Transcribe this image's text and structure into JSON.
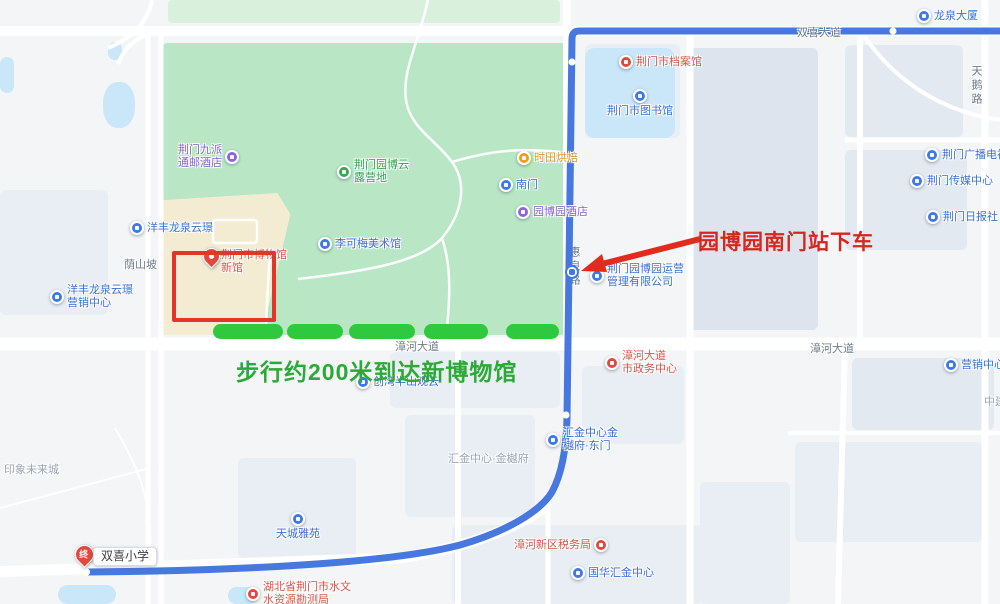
{
  "map_app": "chinese-web-map-route-view",
  "annotations": {
    "alight_text": "园博园南门站下车",
    "walk_text": "步行约200米到达新博物馆",
    "end_pin_char": "终",
    "end_label": "双喜小学"
  },
  "colors": {
    "route_blue": "#4678df",
    "walk_dash_green": "#2fc93f",
    "walk_text_green": "#2caa36",
    "annotation_red": "#d8251d",
    "highlight_box_red": "#e2352b",
    "park_green": "#b9e7c6",
    "water_blue": "#c9e7f8"
  },
  "road_labels": [
    {
      "id": "shuangxi-avenue",
      "text": "双喜大道",
      "x": 797,
      "y": 24,
      "vertical": false
    },
    {
      "id": "zhanghe-avenue-center",
      "text": "漳河大道",
      "x": 395,
      "y": 338,
      "vertical": false
    },
    {
      "id": "zhanghe-avenue-east",
      "text": "漳河大道",
      "x": 810,
      "y": 340,
      "vertical": false
    },
    {
      "id": "tiane-road",
      "text": "天鹅路",
      "x": 968,
      "y": 65,
      "vertical": true
    },
    {
      "id": "yinshanpo-road",
      "text": "荫山坡",
      "x": 124,
      "y": 256,
      "vertical": false
    },
    {
      "id": "huiquan-road",
      "text": "惠泉路",
      "x": 566,
      "y": 246,
      "vertical": true
    }
  ],
  "area_labels": [
    {
      "id": "huijin-center-jinyuefu",
      "text": "汇金中心·金樾府",
      "x": 448,
      "y": 450
    },
    {
      "id": "yinxiang-future-city",
      "text": "印象未来城",
      "x": 4,
      "y": 461
    },
    {
      "id": "zhongjian-partial",
      "text": "中建",
      "x": 984,
      "y": 393
    }
  ],
  "pois": [
    {
      "id": "longquan-tower",
      "kind": "blue",
      "x": 924,
      "y": 16,
      "side": "right",
      "lines": [
        "龙泉大厦"
      ]
    },
    {
      "id": "jingmen-archives",
      "kind": "red",
      "x": 626,
      "y": 62,
      "side": "right",
      "lines": [
        "荆门市档案馆"
      ]
    },
    {
      "id": "jingmen-library",
      "kind": "blue",
      "x": 640,
      "y": 96,
      "side": "below",
      "lines": [
        "荆门市图书馆"
      ]
    },
    {
      "id": "jingmen-radio-tv",
      "kind": "blue",
      "x": 932,
      "y": 155,
      "side": "right",
      "lines": [
        "荆门广播电视台"
      ]
    },
    {
      "id": "jingmen-media-center",
      "kind": "blue",
      "x": 917,
      "y": 181,
      "side": "right",
      "lines": [
        "荆门传媒中心"
      ]
    },
    {
      "id": "jingmen-daily",
      "kind": "blue",
      "x": 933,
      "y": 217,
      "side": "right",
      "lines": [
        "荆门日报社"
      ]
    },
    {
      "id": "jiupai-hotel",
      "kind": "purple",
      "x": 232,
      "y": 157,
      "side": "left",
      "lines": [
        "荆门九派",
        "通邮酒店"
      ]
    },
    {
      "id": "yuanbo-camp",
      "kind": "green",
      "x": 344,
      "y": 172,
      "side": "right",
      "lines": [
        "荆门园博云",
        "露营地"
      ]
    },
    {
      "id": "shitian-bakery",
      "kind": "orange",
      "x": 524,
      "y": 158,
      "side": "right",
      "lines": [
        "时田烘焙"
      ]
    },
    {
      "id": "south-gate",
      "kind": "blue",
      "x": 506,
      "y": 185,
      "side": "right",
      "lines": [
        "南门"
      ]
    },
    {
      "id": "yuanbo-hotel",
      "kind": "purple",
      "x": 523,
      "y": 212,
      "side": "right",
      "lines": [
        "园博园酒店"
      ]
    },
    {
      "id": "yuanbo-mgmt-co",
      "kind": "blue",
      "x": 597,
      "y": 276,
      "side": "right",
      "lines": [
        "荆门园博园运营",
        "管理有限公司"
      ]
    },
    {
      "id": "likemei-gallery",
      "kind": "blue",
      "x": 325,
      "y": 244,
      "side": "right",
      "lines": [
        "李可梅美术馆"
      ]
    },
    {
      "id": "museum-new-hall",
      "kind": "pin",
      "x": 211,
      "y": 262,
      "side": "right",
      "lines": [
        "荆门市博物馆",
        "新馆"
      ]
    },
    {
      "id": "yangfeng-longquan-yunjing",
      "kind": "blue",
      "x": 137,
      "y": 228,
      "side": "right",
      "lines": [
        "洋丰龙泉云璟"
      ]
    },
    {
      "id": "yangfeng-sales-center",
      "kind": "blue",
      "x": 57,
      "y": 297,
      "side": "right",
      "lines": [
        "洋丰龙泉云璟",
        "营销中心"
      ]
    },
    {
      "id": "chuangwan-banshan",
      "kind": "blue",
      "x": 363,
      "y": 382,
      "side": "right",
      "lines": [
        "创湾半山观云"
      ]
    },
    {
      "id": "zhanghe-civic-center",
      "kind": "red",
      "x": 612,
      "y": 363,
      "side": "right",
      "lines": [
        "漳河大道",
        "市政务中心"
      ]
    },
    {
      "id": "sales-center",
      "kind": "blue",
      "x": 951,
      "y": 365,
      "side": "right",
      "lines": [
        "营销中心"
      ]
    },
    {
      "id": "huijin-east-gate",
      "kind": "blue",
      "x": 553,
      "y": 440,
      "side": "right",
      "lines": [
        "汇金中心金",
        "樾府·东门"
      ]
    },
    {
      "id": "tiancheng-yayuan",
      "kind": "blue",
      "x": 298,
      "y": 519,
      "side": "below",
      "lines": [
        "天城雅苑"
      ]
    },
    {
      "id": "hydrology-bureau",
      "kind": "red",
      "x": 253,
      "y": 594,
      "side": "right",
      "lines": [
        "湖北省荆门市水文",
        "水资源勘测局"
      ]
    },
    {
      "id": "tax-bureau",
      "kind": "red",
      "x": 601,
      "y": 545,
      "side": "left",
      "lines": [
        "漳河新区税务局"
      ]
    },
    {
      "id": "guohua-huijin-center",
      "kind": "blue",
      "x": 578,
      "y": 573,
      "side": "right",
      "lines": [
        "国华汇金中心"
      ]
    }
  ],
  "walk_dashes": [
    {
      "x": 213,
      "w": 70
    },
    {
      "x": 287,
      "w": 56
    },
    {
      "x": 349,
      "w": 66
    },
    {
      "x": 424,
      "w": 64
    },
    {
      "x": 506,
      "w": 53
    }
  ]
}
